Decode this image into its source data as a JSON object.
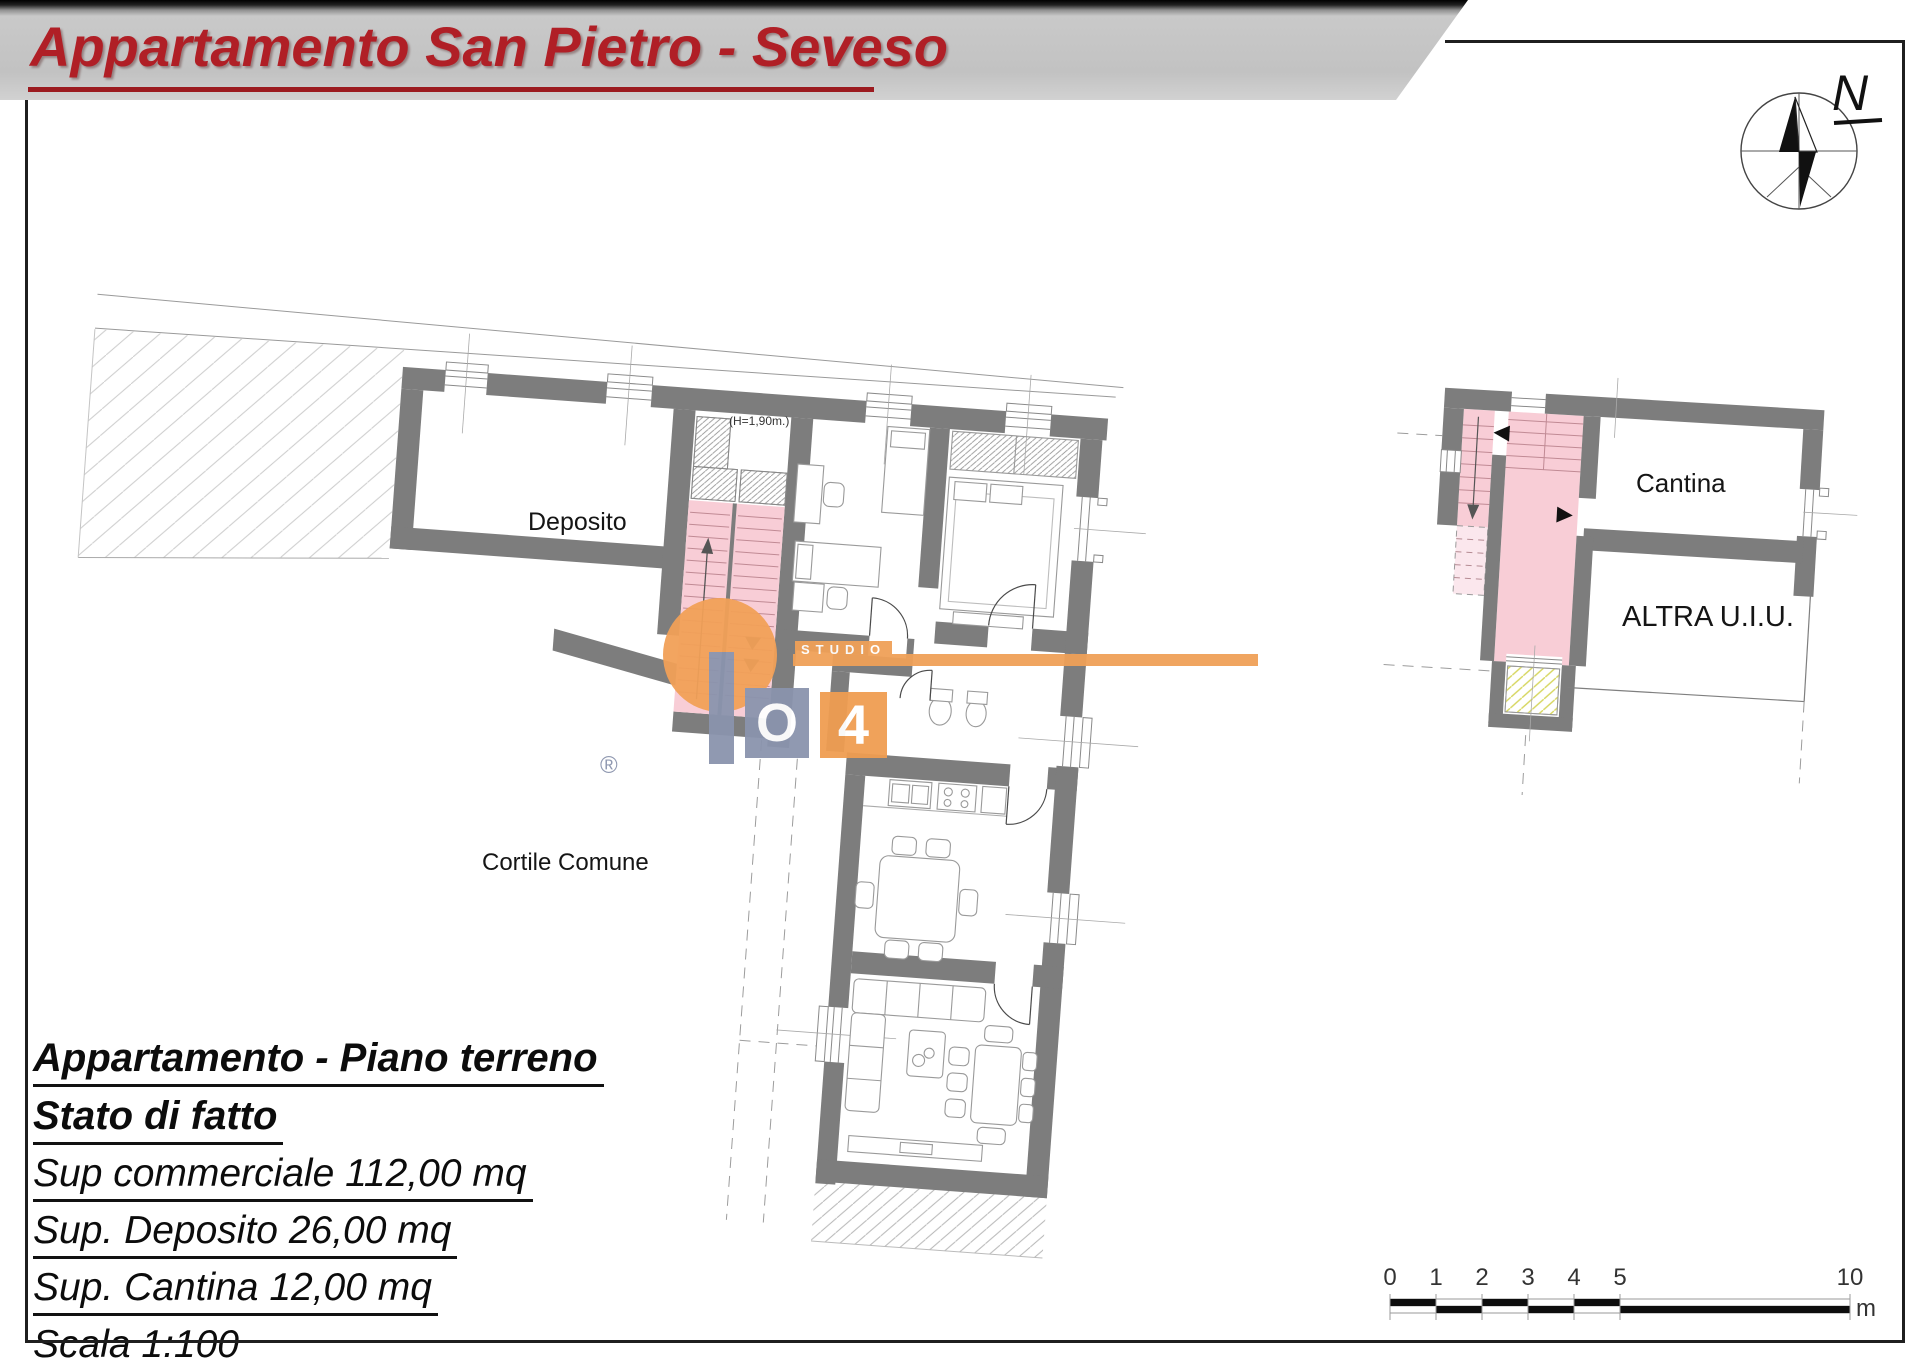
{
  "banner": {
    "title": "Appartamento San Pietro - Seveso",
    "text_color": "#b01f26",
    "underline_color": "#9c1b20"
  },
  "compass": {
    "label": "N"
  },
  "main_plan": {
    "labels": {
      "deposito": "Deposito",
      "cortile": "Cortile Comune",
      "height_note": "(H=1,90m.)"
    },
    "wall_color": "#7d7d7d",
    "stair_fill": "#f8cdd6"
  },
  "cellar_plan": {
    "labels": {
      "cantina": "Cantina",
      "altra": "ALTRA U.I.U."
    }
  },
  "watermark": {
    "studio_label": "STUDIO",
    "o_label": "O",
    "four_label": "4",
    "registered": "®",
    "site_www": "www.",
    "site_domain": "IMMOBILIARE04",
    "site_tld": ".it",
    "since_prefix": "dal ",
    "since_year": "1999",
    "agent": "Geom. Paolo Bonacina",
    "orange": "#f09d52",
    "blue": "#8b94ad",
    "text_gray": "#8c96a6"
  },
  "info_block": {
    "lines": [
      {
        "text": "Appartamento - Piano terreno",
        "bold": true
      },
      {
        "text": "Stato di fatto",
        "bold": true
      },
      {
        "text": "Sup commerciale 112,00 mq",
        "bold": false
      },
      {
        "text": "Sup. Deposito 26,00 mq",
        "bold": false
      },
      {
        "text": "Sup. Cantina 12,00 mq",
        "bold": false
      },
      {
        "text": "Scala 1:100",
        "bold": false
      }
    ]
  },
  "scale_bar": {
    "ticks": [
      "0",
      "1",
      "2",
      "3",
      "4",
      "5",
      "10"
    ],
    "unit_label": "m"
  }
}
